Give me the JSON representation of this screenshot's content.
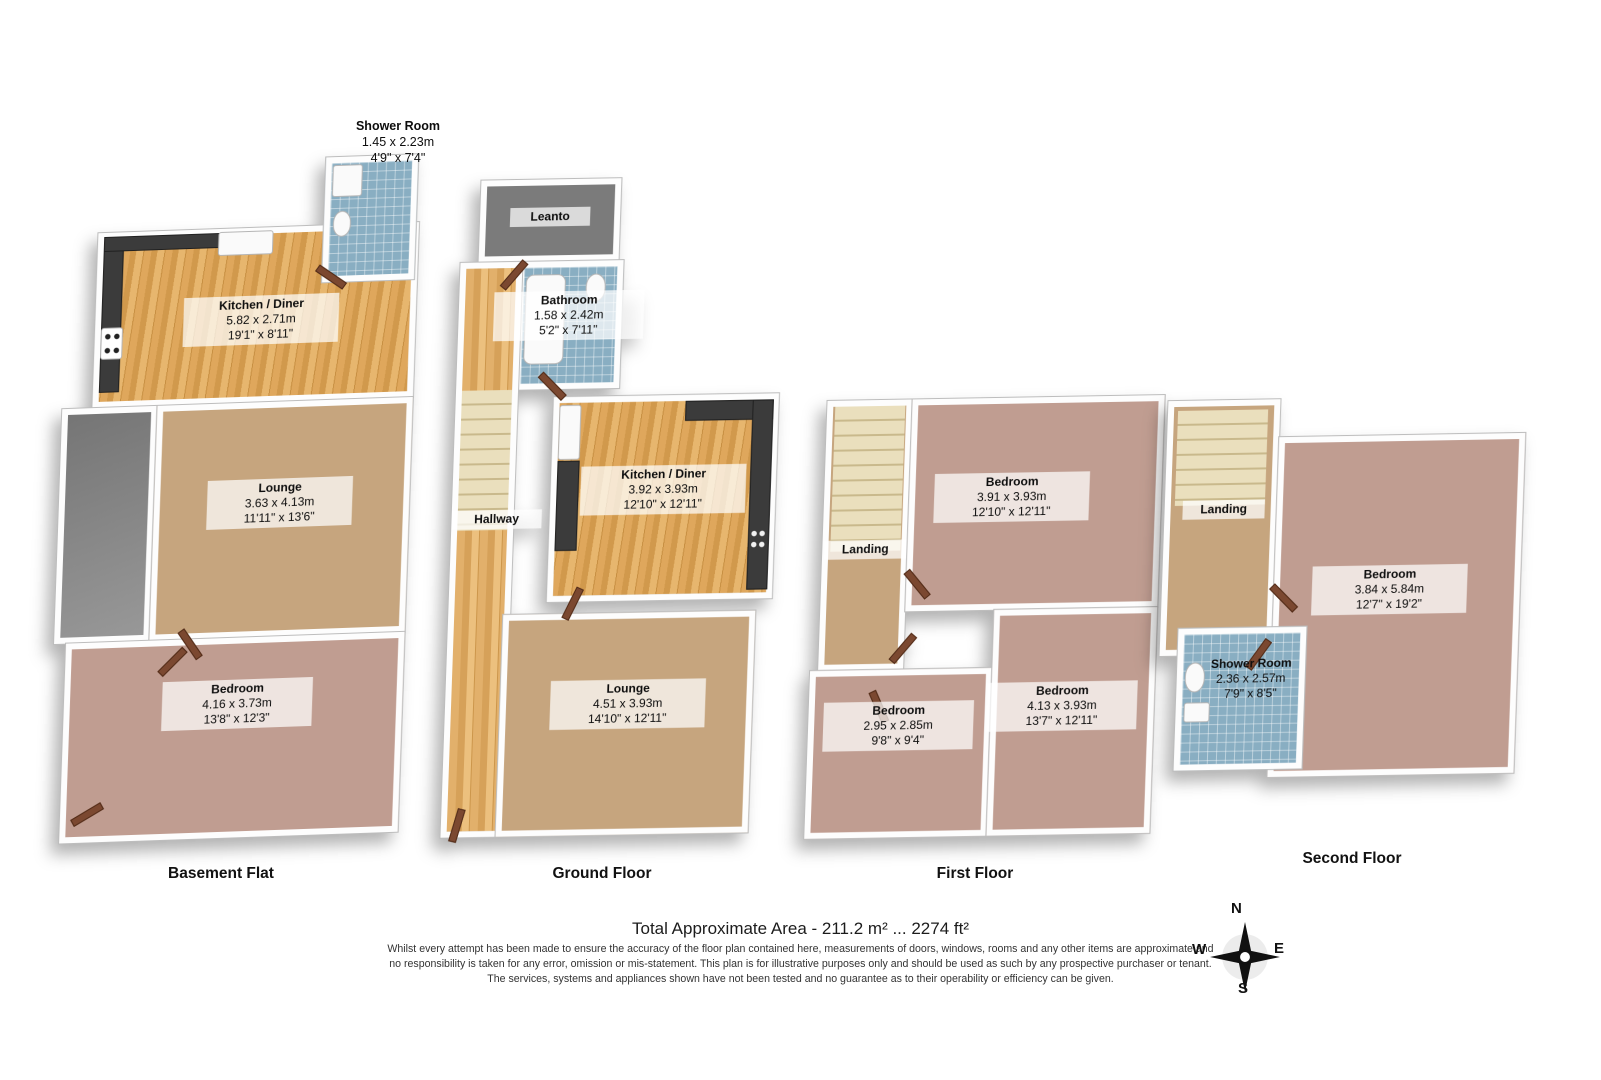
{
  "floors": [
    {
      "title": "Basement Flat",
      "rooms": {
        "shower": {
          "name": "Shower Room",
          "metric": "1.45 x 2.23m",
          "imperial": "4'9\" x 7'4\""
        },
        "kitchen": {
          "name": "Kitchen / Diner",
          "metric": "5.82 x 2.71m",
          "imperial": "19'1\" x 8'11\""
        },
        "lounge": {
          "name": "Lounge",
          "metric": "3.63 x 4.13m",
          "imperial": "11'11\" x 13'6\""
        },
        "bedroom": {
          "name": "Bedroom",
          "metric": "4.16 x 3.73m",
          "imperial": "13'8\" x 12'3\""
        }
      }
    },
    {
      "title": "Ground Floor",
      "rooms": {
        "leanto": {
          "name": "Leanto"
        },
        "bathroom": {
          "name": "Bathroom",
          "metric": "1.58 x 2.42m",
          "imperial": "5'2\" x 7'11\""
        },
        "hallway": {
          "name": "Hallway"
        },
        "kitchen": {
          "name": "Kitchen / Diner",
          "metric": "3.92 x 3.93m",
          "imperial": "12'10\" x 12'11\""
        },
        "lounge": {
          "name": "Lounge",
          "metric": "4.51 x 3.93m",
          "imperial": "14'10\" x 12'11\""
        }
      }
    },
    {
      "title": "First Floor",
      "rooms": {
        "landing": {
          "name": "Landing"
        },
        "bedroom1": {
          "name": "Bedroom",
          "metric": "3.91 x 3.93m",
          "imperial": "12'10\" x 12'11\""
        },
        "bedroom2": {
          "name": "Bedroom",
          "metric": "2.95 x 2.85m",
          "imperial": "9'8\" x 9'4\""
        },
        "bedroom3": {
          "name": "Bedroom",
          "metric": "4.13 x 3.93m",
          "imperial": "13'7\" x 12'11\""
        }
      }
    },
    {
      "title": "Second Floor",
      "rooms": {
        "landing": {
          "name": "Landing"
        },
        "bedroom": {
          "name": "Bedroom",
          "metric": "3.84 x 5.84m",
          "imperial": "12'7\" x 19'2\""
        },
        "shower": {
          "name": "Shower Room",
          "metric": "2.36 x 2.57m",
          "imperial": "7'9\" x 8'5\""
        }
      }
    }
  ],
  "footer": {
    "total_area": "Total Approximate Area - 211.2 m² ... 2274 ft²",
    "disclaimer1": "Whilst every attempt has been made to ensure the accuracy of the floor plan contained here, measurements of doors, windows, rooms and any other items are approximate and",
    "disclaimer2": "no responsibility is taken for any error, omission or mis-statement.  This plan is for illustrative purposes only and should be used as such by any prospective purchaser or tenant.",
    "disclaimer3": "The services, systems and appliances shown have not been tested and no guarantee as to their operability or efficiency can be given."
  },
  "compass": {
    "n": "N",
    "e": "E",
    "s": "S",
    "w": "W"
  },
  "colors": {
    "wood": "#d9a257",
    "carpet_tan": "#c6a57e",
    "carpet_mauve": "#c09d91",
    "tile_blue": "#89aec2",
    "floor_gray": "#8f8f8f",
    "stairs_cream": "#eadfbd",
    "door_brown": "#7b4830",
    "counter_dark": "#3b3b3b",
    "wall_white": "#ffffff"
  }
}
